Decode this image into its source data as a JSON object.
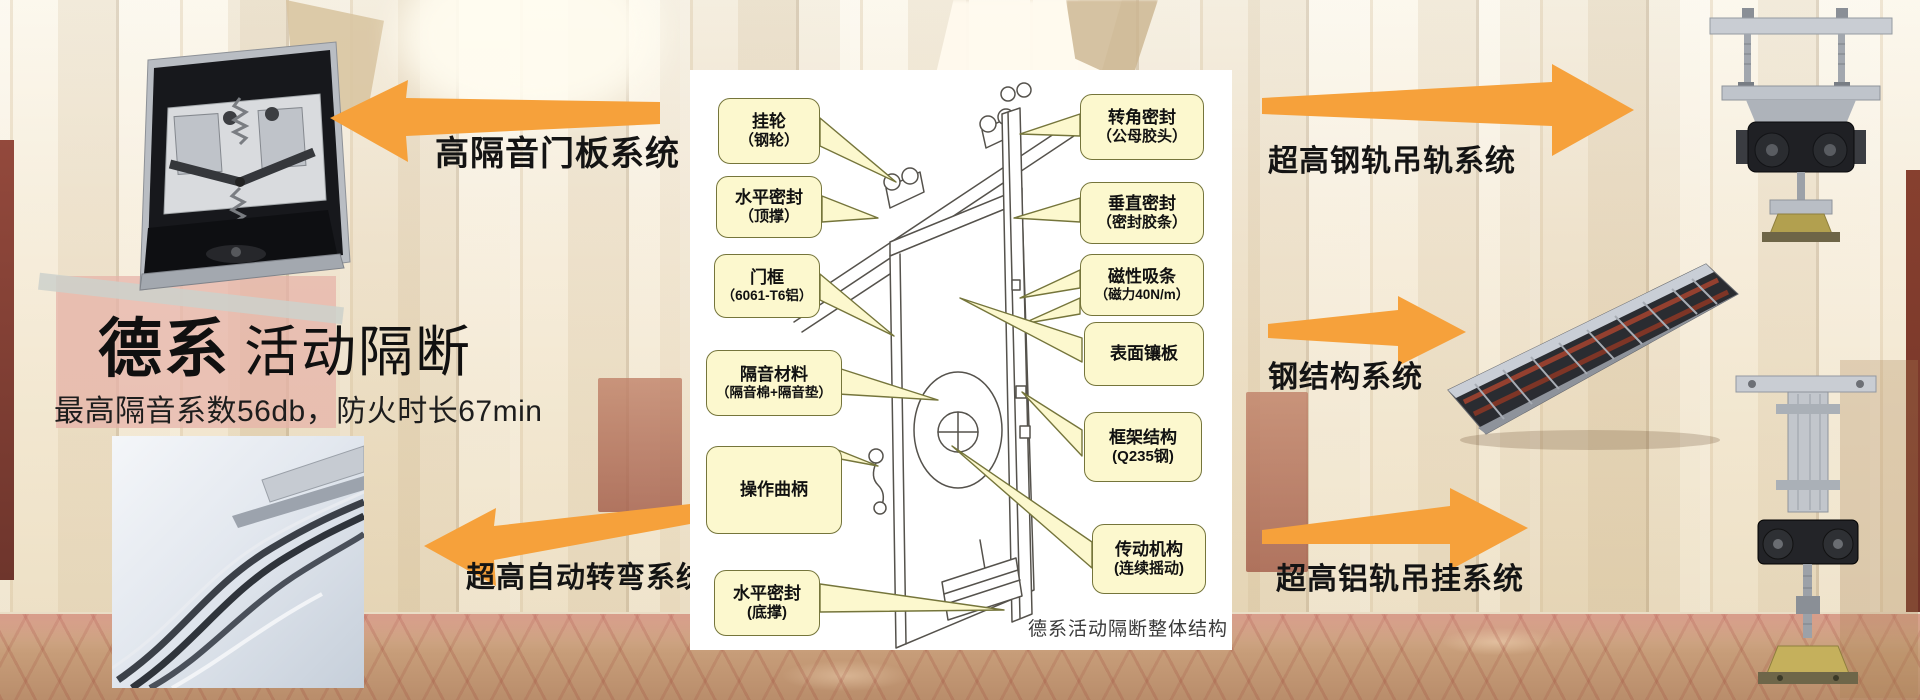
{
  "title": {
    "bold": "德系",
    "light": "活动隔断",
    "subtitle": "最高隔音系数56db，防火时长67min"
  },
  "system_labels": {
    "door_panel": "高隔音门板系统",
    "auto_turning": "超高自动转弯系统",
    "steel_rail": "超高钢轨吊轨系统",
    "steel_structure": "钢结构系统",
    "aluminum_rail": "超高铝轨吊挂系统"
  },
  "diagram": {
    "caption": "德系活动隔断整体结构",
    "callouts_left": [
      {
        "line1": "挂轮",
        "line2": "（钢轮）"
      },
      {
        "line1": "水平密封",
        "line2": "（顶撑）"
      },
      {
        "line1": "门框",
        "line2": "（6061-T6铝）"
      },
      {
        "line1": "隔音材料",
        "line2": "（隔音棉+隔音垫）"
      },
      {
        "line1": "操作曲柄",
        "line2": ""
      },
      {
        "line1": "水平密封",
        "line2": "(底撑)"
      }
    ],
    "callouts_right": [
      {
        "line1": "转角密封",
        "line2": "（公母胶头）"
      },
      {
        "line1": "垂直密封",
        "line2": "（密封胶条）"
      },
      {
        "line1": "磁性吸条",
        "line2": "（磁力40N/m）"
      },
      {
        "line1": "表面镶板",
        "line2": ""
      },
      {
        "line1": "框架结构",
        "line2": "(Q235钢)"
      },
      {
        "line1": "传动机构",
        "line2": "(连续摇动)"
      }
    ]
  },
  "colors": {
    "arrow_orange": "#F6A13B",
    "callout_fill": "#FCF8CE",
    "callout_border": "#75753B",
    "label_black": "#141414"
  }
}
